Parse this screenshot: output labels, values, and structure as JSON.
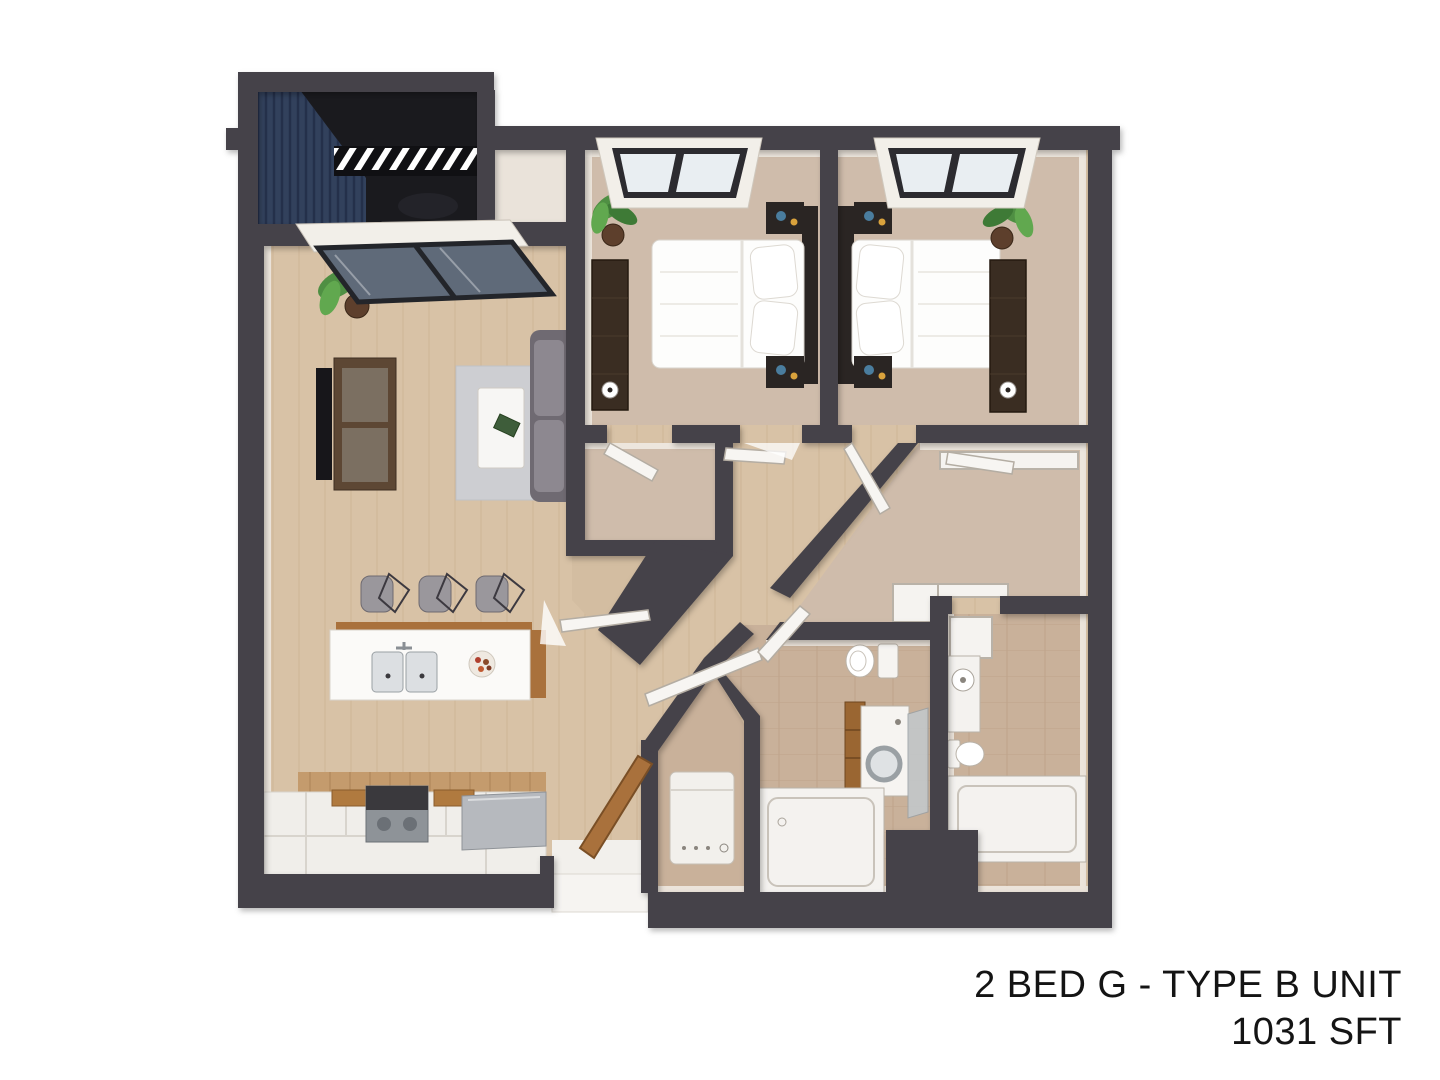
{
  "title": {
    "line1": "2 BED G  - TYPE B UNIT",
    "line2": "1031 SFT"
  },
  "floorplan": {
    "unit": "2 BED G",
    "plan_type": "TYPE B UNIT",
    "area": "1031 SFT",
    "view": "3d-top-down-rendering",
    "rooms": [
      {
        "name": "balcony",
        "features": [
          "louvered-privacy-wall",
          "pergola-slats",
          "lounge-chair"
        ]
      },
      {
        "name": "living-room",
        "features": [
          "tv",
          "media-console",
          "sofa",
          "rug",
          "coffee-table",
          "book",
          "plant",
          "sliding-window"
        ]
      },
      {
        "name": "kitchen",
        "features": [
          "island",
          "double-sink",
          "faucet",
          "fruit-bowl",
          "bar-stools",
          "range",
          "stainless-counter",
          "cutting-boards",
          "cabinets"
        ]
      },
      {
        "name": "bedroom-1",
        "features": [
          "double-bed",
          "pillows",
          "headboard",
          "nightstands",
          "dresser",
          "plant",
          "window",
          "closet-door",
          "entry-door"
        ]
      },
      {
        "name": "bedroom-2",
        "features": [
          "double-bed",
          "pillows",
          "headboard",
          "nightstands",
          "dresser",
          "plant",
          "window",
          "entry-door"
        ]
      },
      {
        "name": "hallway",
        "features": [
          "diagonal-corridor",
          "coat-closet",
          "entry-door-wood",
          "door-swings"
        ]
      },
      {
        "name": "utility-closet",
        "features": [
          "water-heater"
        ]
      },
      {
        "name": "bathroom-1",
        "features": [
          "toilet",
          "washer",
          "drawer-cabinet",
          "glass-panel",
          "bathtub"
        ]
      },
      {
        "name": "bathroom-2",
        "features": [
          "vanity-sink",
          "toilet",
          "bathtub",
          "door"
        ]
      },
      {
        "name": "walk-in-closet",
        "features": [
          "shelf",
          "counter"
        ]
      }
    ]
  },
  "colors": {
    "background": "#ffffff",
    "wall": "#454249",
    "wood_floor": "#d8c2a6",
    "carpet": "#cfbcab",
    "bath_tile": "#c9b19a",
    "cream": "#eae3da",
    "balcony_floor": "#1a1a1e",
    "balcony_navy": "#32415c",
    "accent_wood": "#a9713c",
    "text": "#141414"
  }
}
